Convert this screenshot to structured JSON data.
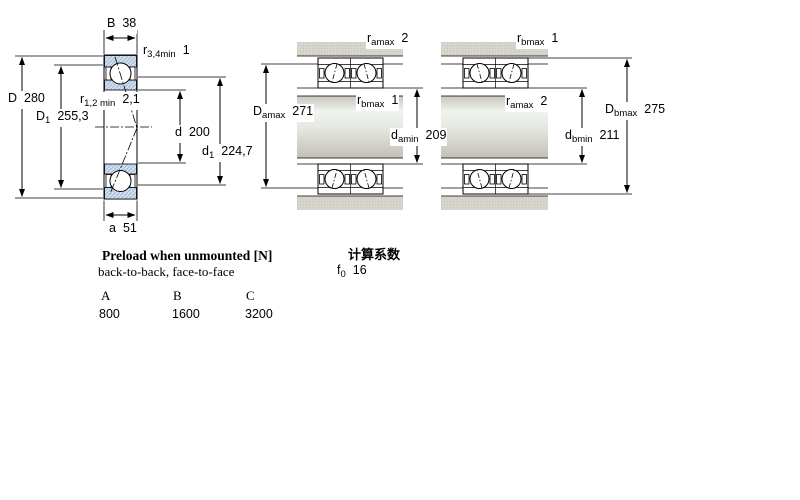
{
  "colors": {
    "bearing_ring_blue": "#cfdeed",
    "bearing_hatch_blue": "#9db7d6",
    "housing_gray": "#d6d3cb",
    "line_black": "#000000"
  },
  "left": {
    "labels": {
      "B": {
        "sym": "B",
        "sub": "",
        "val": "38"
      },
      "r34": {
        "sym": "r",
        "sub": "3,4min",
        "val": "1"
      },
      "D": {
        "sym": "D",
        "sub": "",
        "val": "280"
      },
      "D1": {
        "sym": "D",
        "sub": "1",
        "val": "255,3"
      },
      "r12": {
        "sym": "r",
        "sub": "1,2 min",
        "val": "2,1"
      },
      "d": {
        "sym": "d",
        "sub": "",
        "val": "200"
      },
      "d1": {
        "sym": "d",
        "sub": "1",
        "val": "224,7"
      },
      "a": {
        "sym": "a",
        "sub": "",
        "val": "51"
      }
    }
  },
  "middle": {
    "labels": {
      "ramax": {
        "sym": "r",
        "sub": "amax",
        "val": "2"
      },
      "Damax": {
        "sym": "D",
        "sub": "amax",
        "val": "271"
      },
      "rbmax": {
        "sym": "r",
        "sub": "bmax",
        "val": "1"
      },
      "damin": {
        "sym": "d",
        "sub": "amin",
        "val": "209"
      }
    }
  },
  "right": {
    "labels": {
      "rbmax": {
        "sym": "r",
        "sub": "bmax",
        "val": "1"
      },
      "ramax": {
        "sym": "r",
        "sub": "amax",
        "val": "2"
      },
      "Dbmax": {
        "sym": "D",
        "sub": "bmax",
        "val": "275"
      },
      "dbmin": {
        "sym": "d",
        "sub": "bmin",
        "val": "211"
      }
    }
  },
  "preload": {
    "title": "Preload when unmounted [N]",
    "subtitle": "back-to-back, face-to-face",
    "columns": [
      "A",
      "B",
      "C"
    ],
    "values": [
      "800",
      "1600",
      "3200"
    ]
  },
  "calc": {
    "title": "计算系数",
    "f0": {
      "sym": "f",
      "sub": "0",
      "val": "16"
    }
  }
}
